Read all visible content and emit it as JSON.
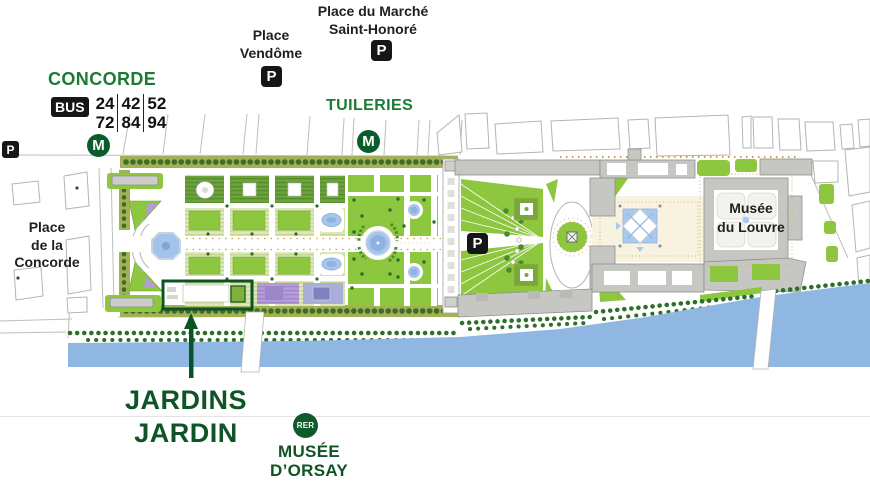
{
  "labels": {
    "place_marche": {
      "line1": "Place du Marché",
      "line2": "Saint-Honoré"
    },
    "place_vendome": {
      "line1": "Place",
      "line2": "Vendôme"
    },
    "place_concorde": {
      "line1": "Place",
      "line2": "de la",
      "line3": "Concorde"
    },
    "musee_louvre": {
      "line1": "Musée",
      "line2": "du Louvre"
    }
  },
  "stations": {
    "concorde": "CONCORDE",
    "tuileries": "TUILERIES",
    "musee_orsay": {
      "line1": "MUSÉE",
      "line2": "D’ORSAY"
    }
  },
  "transit": {
    "metro_symbol": "M",
    "parking_symbol": "P",
    "bus_label": "BUS",
    "rer_symbol": "RER",
    "bus_lines_row1": [
      "24",
      "42",
      "52"
    ],
    "bus_lines_row2": [
      "72",
      "84",
      "94"
    ]
  },
  "event": {
    "title_line1": "JARDINS",
    "title_line2": "JARDIN"
  },
  "colors": {
    "station_green": "#1b7a33",
    "deep_green": "#0f5426",
    "highlight_green": "#0b5323",
    "river_blue": "#90b7e2",
    "lawn_green": "#8dc63f",
    "badge_black": "#161616"
  }
}
